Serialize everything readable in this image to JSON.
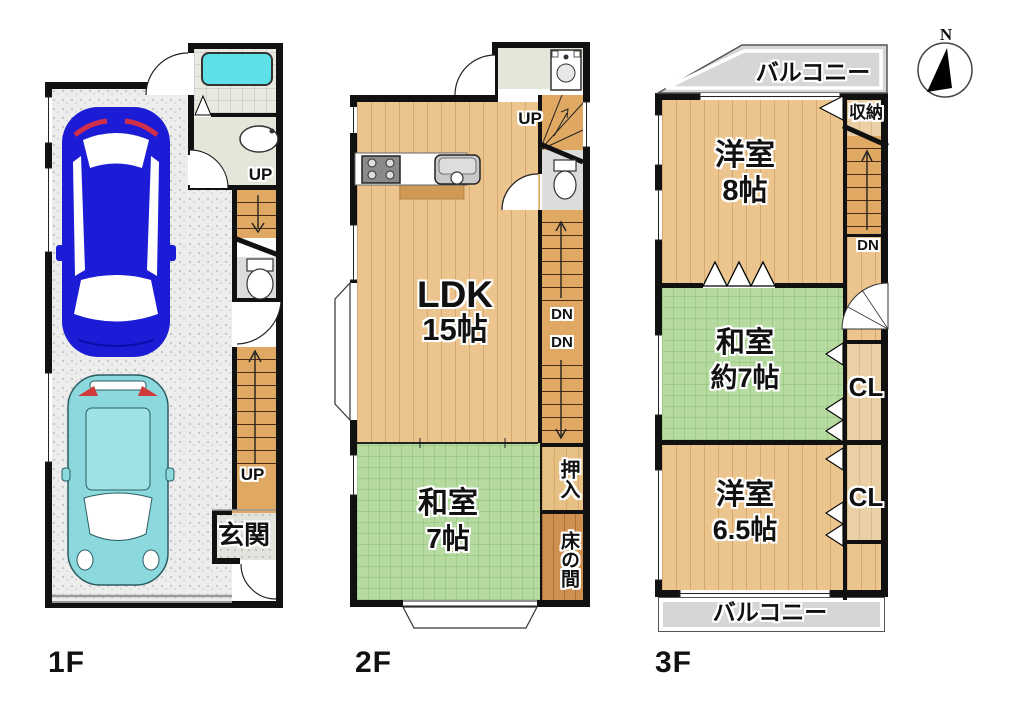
{
  "compass": {
    "label": "N"
  },
  "floors": {
    "f1": {
      "label": "1F",
      "entrance": "玄関",
      "stairs_up_main": "UP",
      "stairs_up_side": "UP"
    },
    "f2": {
      "label": "2F",
      "ldk_name": "LDK",
      "ldk_size": "15帖",
      "tatami_name": "和室",
      "tatami_size": "7帖",
      "oshiire": "押入",
      "tokonoma": "床の間",
      "up": "UP",
      "dn_a": "DN",
      "dn_b": "DN"
    },
    "f3": {
      "label": "3F",
      "balcony_top": "バルコニー",
      "balcony_bottom": "バルコニー",
      "storage": "収納",
      "dn": "DN",
      "west8_name": "洋室",
      "west8_size": "8帖",
      "tatami_name": "和室",
      "tatami_size": "約7帖",
      "west65_name": "洋室",
      "west65_size": "6.5帖",
      "cl_top": "CL",
      "cl_bottom": "CL"
    }
  },
  "colors": {
    "wall": "#111111",
    "wood_floor": "#ecc58e",
    "stair_wood": "#dfa963",
    "tatami_green": "#b6da9f",
    "garage_concrete": "#ededed",
    "entrance_tile": "#e3e3de",
    "balcony_gray": "#d6d6d6",
    "closet_wood": "#ead0a4",
    "oshiire_wood": "#e7c183",
    "tokonoma_wood": "#cf8f4f",
    "bathtub_cyan": "#5ee0e8",
    "washroom_green": "#e2e7d9",
    "bathroom_tile": "#e9e9e2",
    "toilet_gray": "#dcdcdc",
    "car_blue": "#1c1cd6",
    "car_teal": "#8bd9dd"
  }
}
